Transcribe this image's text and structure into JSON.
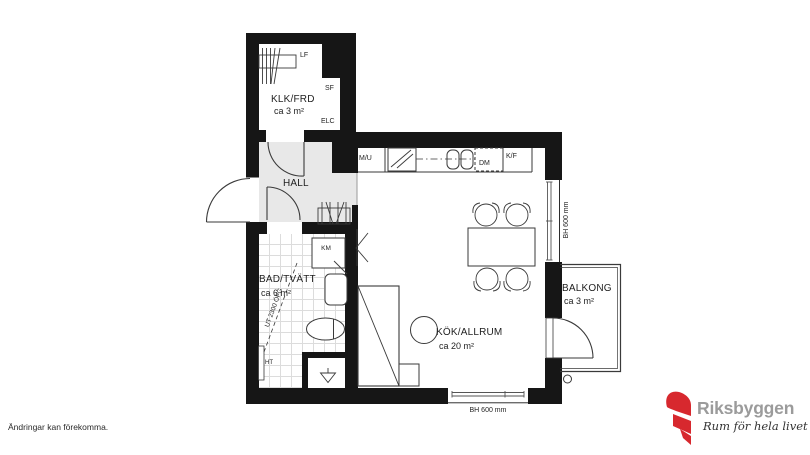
{
  "plan": {
    "rooms": {
      "klk": {
        "label": "KLK/FRD",
        "area": "ca 3 m²"
      },
      "hall": {
        "label": "HALL"
      },
      "bad": {
        "label": "BAD/TVÄTT",
        "area": "ca 6 m²",
        "ceiling_note": "UT 2300 ÖFG"
      },
      "kok": {
        "label": "KÖK/ALLRUM",
        "area": "ca 20 m²"
      },
      "balkong": {
        "label": "BALKONG",
        "area": "ca 3 m²"
      }
    },
    "fixtures": {
      "lf": "LF",
      "sf": "SF",
      "elc": "ELC",
      "mu": "M/U",
      "dm": "DM",
      "kf": "K/F",
      "km": "KM",
      "ht": "HT"
    },
    "windows": {
      "right": "BH 600 mm",
      "bottom": "BH 600 mm"
    }
  },
  "footer": {
    "disclaimer": "Ändringar kan förekomma."
  },
  "brand": {
    "name": "Riksbyggen",
    "tagline": "Rum för hela livet",
    "red": "#d7282e",
    "gray": "#9b9b9b"
  }
}
